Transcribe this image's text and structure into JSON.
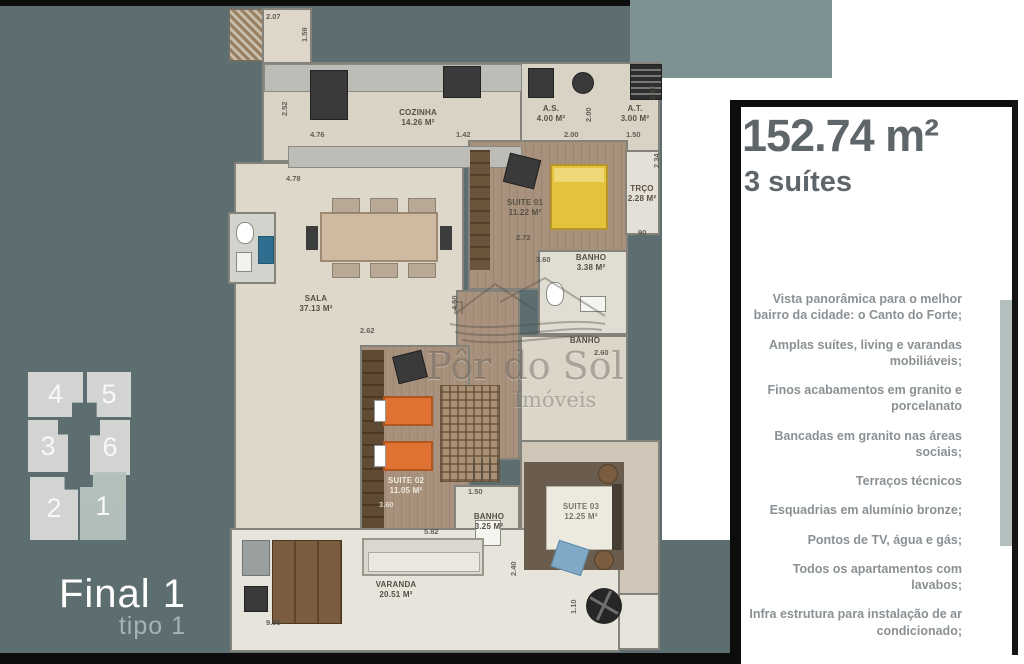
{
  "left_panel": {
    "units": [
      "4",
      "5",
      "3",
      "6",
      "2",
      "1"
    ],
    "highlighted_unit": "1",
    "final_label": "Final 1",
    "tipo_label": "tipo 1",
    "bg_color": "#5d6e71",
    "unit_color": "#d8dad7",
    "highlight_color": "#b7c3bf"
  },
  "right_panel": {
    "area_title": "152.74 m²",
    "suites_subtitle": "3 suítes",
    "title_color": "#5f666a",
    "features": [
      "Vista panorâmica para o melhor bairro da cidade: o Canto do Forte;",
      "Amplas suítes, living e varandas mobiliáveis;",
      "Finos acabamentos em granito e porcelanato",
      "Bancadas em granito nas áreas sociais;",
      "Terraços técnicos",
      "Esquadrias em alumínio bronze;",
      "Pontos de TV, água e gás;",
      "Todos os apartamentos com lavabos;",
      "Infra estrutura para instalação de ar condicionado;"
    ]
  },
  "watermark": {
    "line1": "Pôr do Sol",
    "line2": "Imóveis"
  },
  "plan": {
    "rooms": [
      {
        "name": "COZINHA",
        "area": "14.26 M²"
      },
      {
        "name": "A.S.",
        "area": "4.00 M²"
      },
      {
        "name": "A.T.",
        "area": "3.00 M²"
      },
      {
        "name": "TRÇO",
        "area": "2.28 M²"
      },
      {
        "name": "SUITE 01",
        "area": "11.22 M²"
      },
      {
        "name": "BANHO",
        "area": "3.38 M²"
      },
      {
        "name": "SALA",
        "area": "37.13 M²"
      },
      {
        "name": "BANHO",
        "area": ""
      },
      {
        "name": "SUITE 02",
        "area": "11.05 M²"
      },
      {
        "name": "BANHO",
        "area": "3.25 M²"
      },
      {
        "name": "SUITE 03",
        "area": "12.25 M²"
      },
      {
        "name": "VARANDA",
        "area": "20.51 M²"
      }
    ],
    "dims": [
      "2.07",
      "1.59",
      "2.52",
      "4.76",
      "1.42",
      "2.00",
      "2.00",
      "1.50",
      "2.20",
      "2.34",
      "90",
      "4.78",
      "2.72",
      "3.60",
      "2.62",
      "4.50",
      "2.60",
      "3.60",
      "1.50",
      "5.82",
      "9.98",
      "1.10",
      "2.40"
    ]
  }
}
